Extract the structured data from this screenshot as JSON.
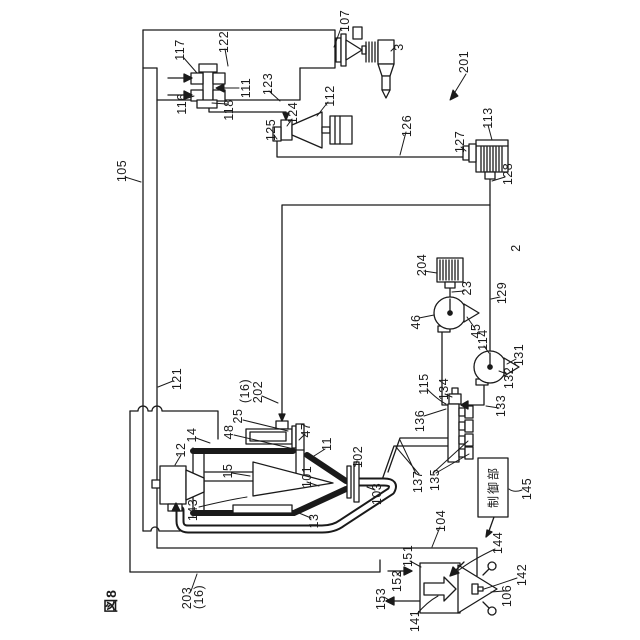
{
  "figure": {
    "number": "図8"
  },
  "colors": {
    "ink": "#1a1a1a",
    "bg": "#ffffff"
  },
  "control_unit": {
    "text": "制御部",
    "ref": "145"
  },
  "labels": {
    "107": "107",
    "3": "3",
    "201": "201",
    "117": "117",
    "122": "122",
    "111": "111",
    "123": "123",
    "116": "116",
    "118": "118",
    "112": "112",
    "124": "124",
    "125": "125",
    "126": "126",
    "113": "113",
    "127": "127",
    "128": "128",
    "105": "105",
    "204": "204",
    "23": "23",
    "2": "2",
    "46": "46",
    "129": "129",
    "45": "45",
    "114": "114",
    "131": "131",
    "132": "132",
    "121": "121",
    "133": "133",
    "134": "134",
    "16a": "(16)",
    "202": "202",
    "115": "115",
    "136": "136",
    "14": "14",
    "48": "48",
    "25": "25",
    "47": "47",
    "11": "11",
    "12": "12",
    "15": "15",
    "101": "101",
    "102": "102",
    "143": "143",
    "13": "13",
    "103": "103",
    "137": "137",
    "135": "135",
    "104": "104",
    "145": "145",
    "151": "151",
    "144": "144",
    "152": "152",
    "142": "142",
    "153": "153",
    "106": "106",
    "141": "141",
    "203": "203",
    "16b": "(16)",
    "fig": "図8",
    "ctrl": "制御部"
  }
}
